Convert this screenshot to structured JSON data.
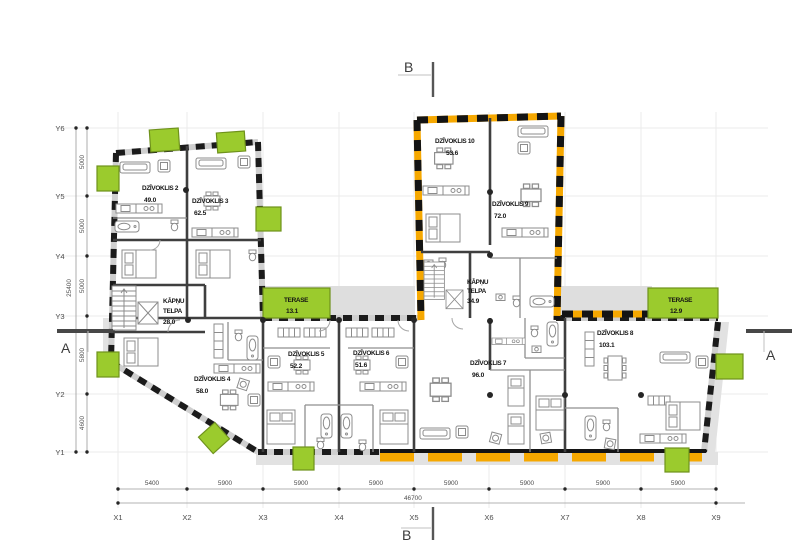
{
  "apartments": [
    {
      "name": "DZĪVOKLIS 2",
      "area": "49.0"
    },
    {
      "name": "DZĪVOKLIS 3",
      "area": "62.5"
    },
    {
      "name": "DZĪVOKLIS 4",
      "area": "58.0"
    },
    {
      "name": "DZĪVOKLIS 5",
      "area": "52.2"
    },
    {
      "name": "DZĪVOKLIS 6",
      "area": "51.6"
    },
    {
      "name": "DZĪVOKLIS 7",
      "area": "96.0"
    },
    {
      "name": "DZĪVOKLIS 8",
      "area": "103.1"
    },
    {
      "name": "DZĪVOKLIS 9",
      "area": "72.0"
    },
    {
      "name": "DZĪVOKLIS 10",
      "area": "53.6"
    }
  ],
  "stairwells": [
    {
      "line1": "KĀPŅU",
      "line2": "TELPA",
      "area": "28.0"
    },
    {
      "line1": "KĀPŅU",
      "line2": "TELPA",
      "area": "34.9"
    }
  ],
  "terraces": [
    {
      "name": "TERASE",
      "area": "13.1"
    },
    {
      "name": "TERASE",
      "area": "12.9"
    }
  ],
  "axes": {
    "x": [
      "X1",
      "X2",
      "X3",
      "X4",
      "X5",
      "X6",
      "X7",
      "X8",
      "X9"
    ],
    "y": [
      "Y6",
      "Y5",
      "Y4",
      "Y3",
      "Y2",
      "Y1"
    ]
  },
  "dimensions": {
    "bottom_segments": [
      "5400",
      "5900",
      "5900",
      "5900",
      "5900",
      "5900",
      "5900",
      "5900"
    ],
    "bottom_total": "46700",
    "left_segments": [
      "5000",
      "5000",
      "5000",
      "5800",
      "4600"
    ],
    "left_total": "25400"
  },
  "section_markers": {
    "a": "A",
    "b": "B"
  },
  "colors": {
    "balcony_green": "#9BCB2D",
    "insulation_orange": "#F6A800",
    "wall_black": "#1B1B1B",
    "shadow_gray": "#E2E2E2"
  }
}
